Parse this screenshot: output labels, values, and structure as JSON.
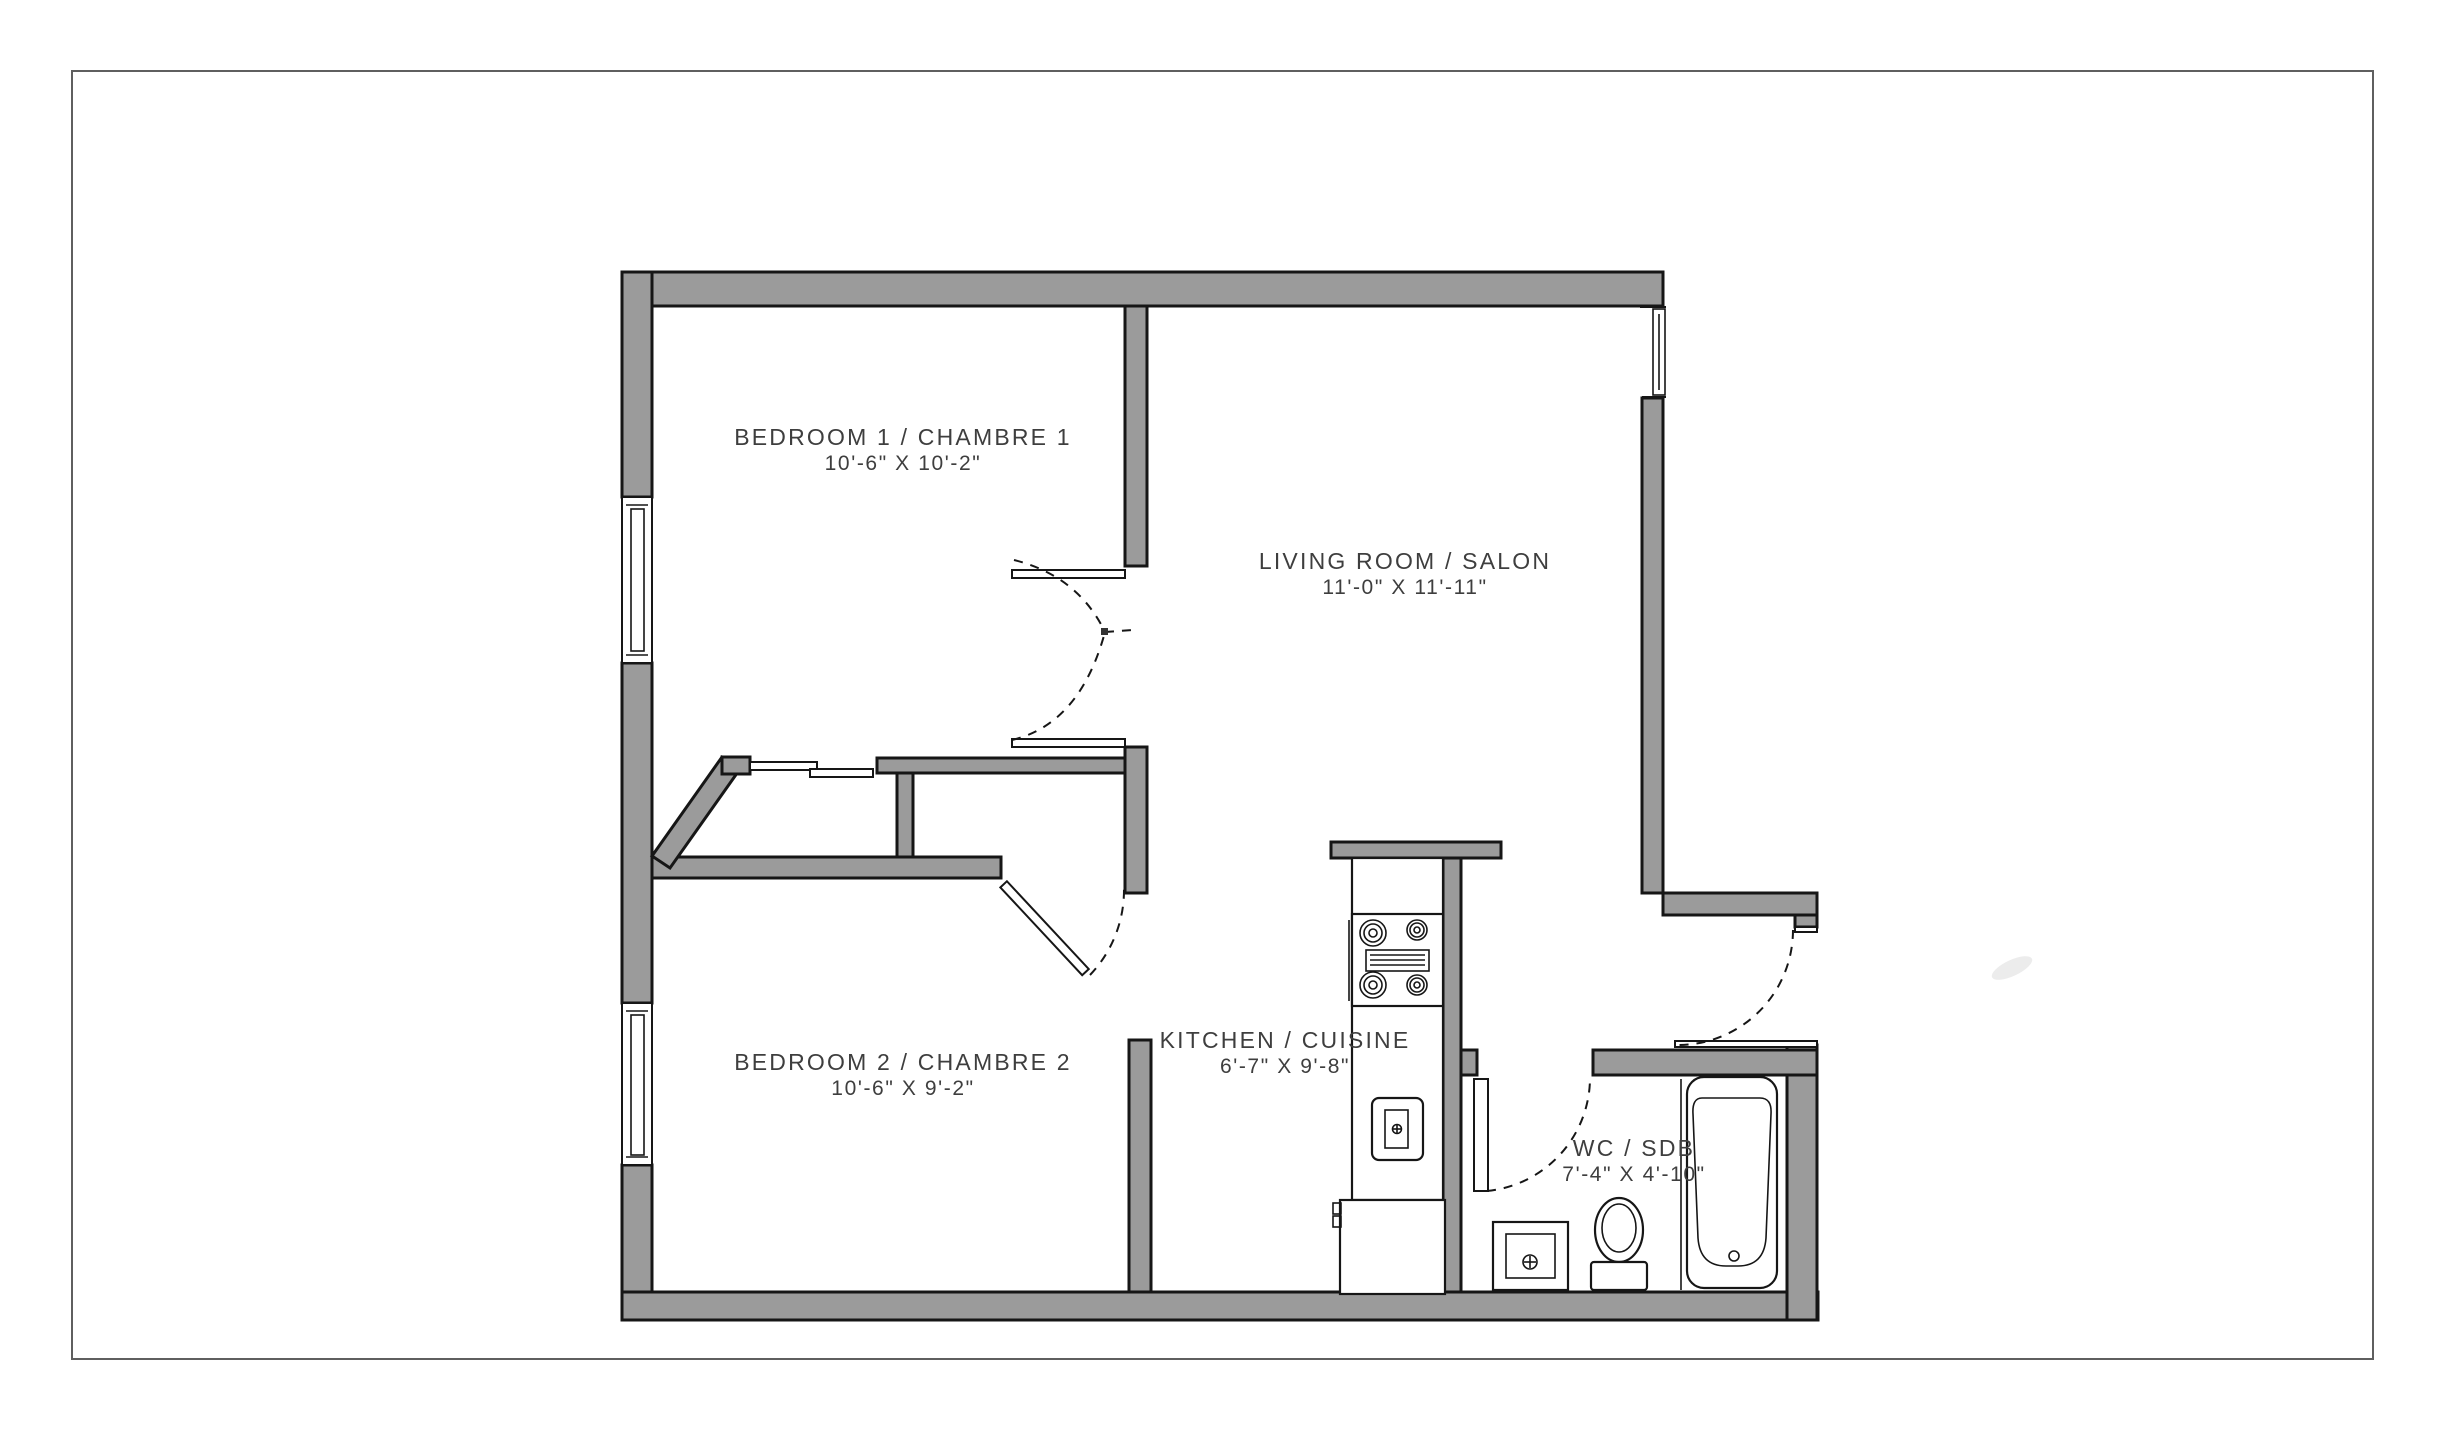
{
  "document": {
    "type": "apartment floor plan"
  },
  "colors": {
    "background": "#ffffff",
    "wall_fill": "#9b9b9b",
    "outline": "#161616",
    "label_text": "#3e3e3e",
    "page_border": "#5f5f5f"
  },
  "rooms": [
    {
      "name": "BEDROOM 1 / CHAMBRE 1",
      "dimensions": "10'-6\" X 10'-2\""
    },
    {
      "name": "LIVING ROOM / SALON",
      "dimensions": "11'-0\" X 11'-11\""
    },
    {
      "name": "BEDROOM 2 / CHAMBRE 2",
      "dimensions": "10'-6\" X 9'-2\""
    },
    {
      "name": "KITCHEN / CUISINE",
      "dimensions": "6'-7\" X 9'-8\""
    },
    {
      "name": "WC / SDB",
      "dimensions": "7'-4\" X 4'-10\""
    }
  ],
  "fixtures": [
    "stove-cooktop",
    "oven",
    "kitchen-sink",
    "refrigerator",
    "bathtub",
    "toilet",
    "bathroom-sink",
    "closet-sliding-doors"
  ],
  "openings": {
    "windows": [
      "bedroom1-west-window",
      "bedroom2-west-window",
      "livingroom-northeast-window"
    ],
    "doors": [
      "bedroom1-double-door",
      "bedroom2-door",
      "bathroom-door",
      "entry-door"
    ]
  }
}
